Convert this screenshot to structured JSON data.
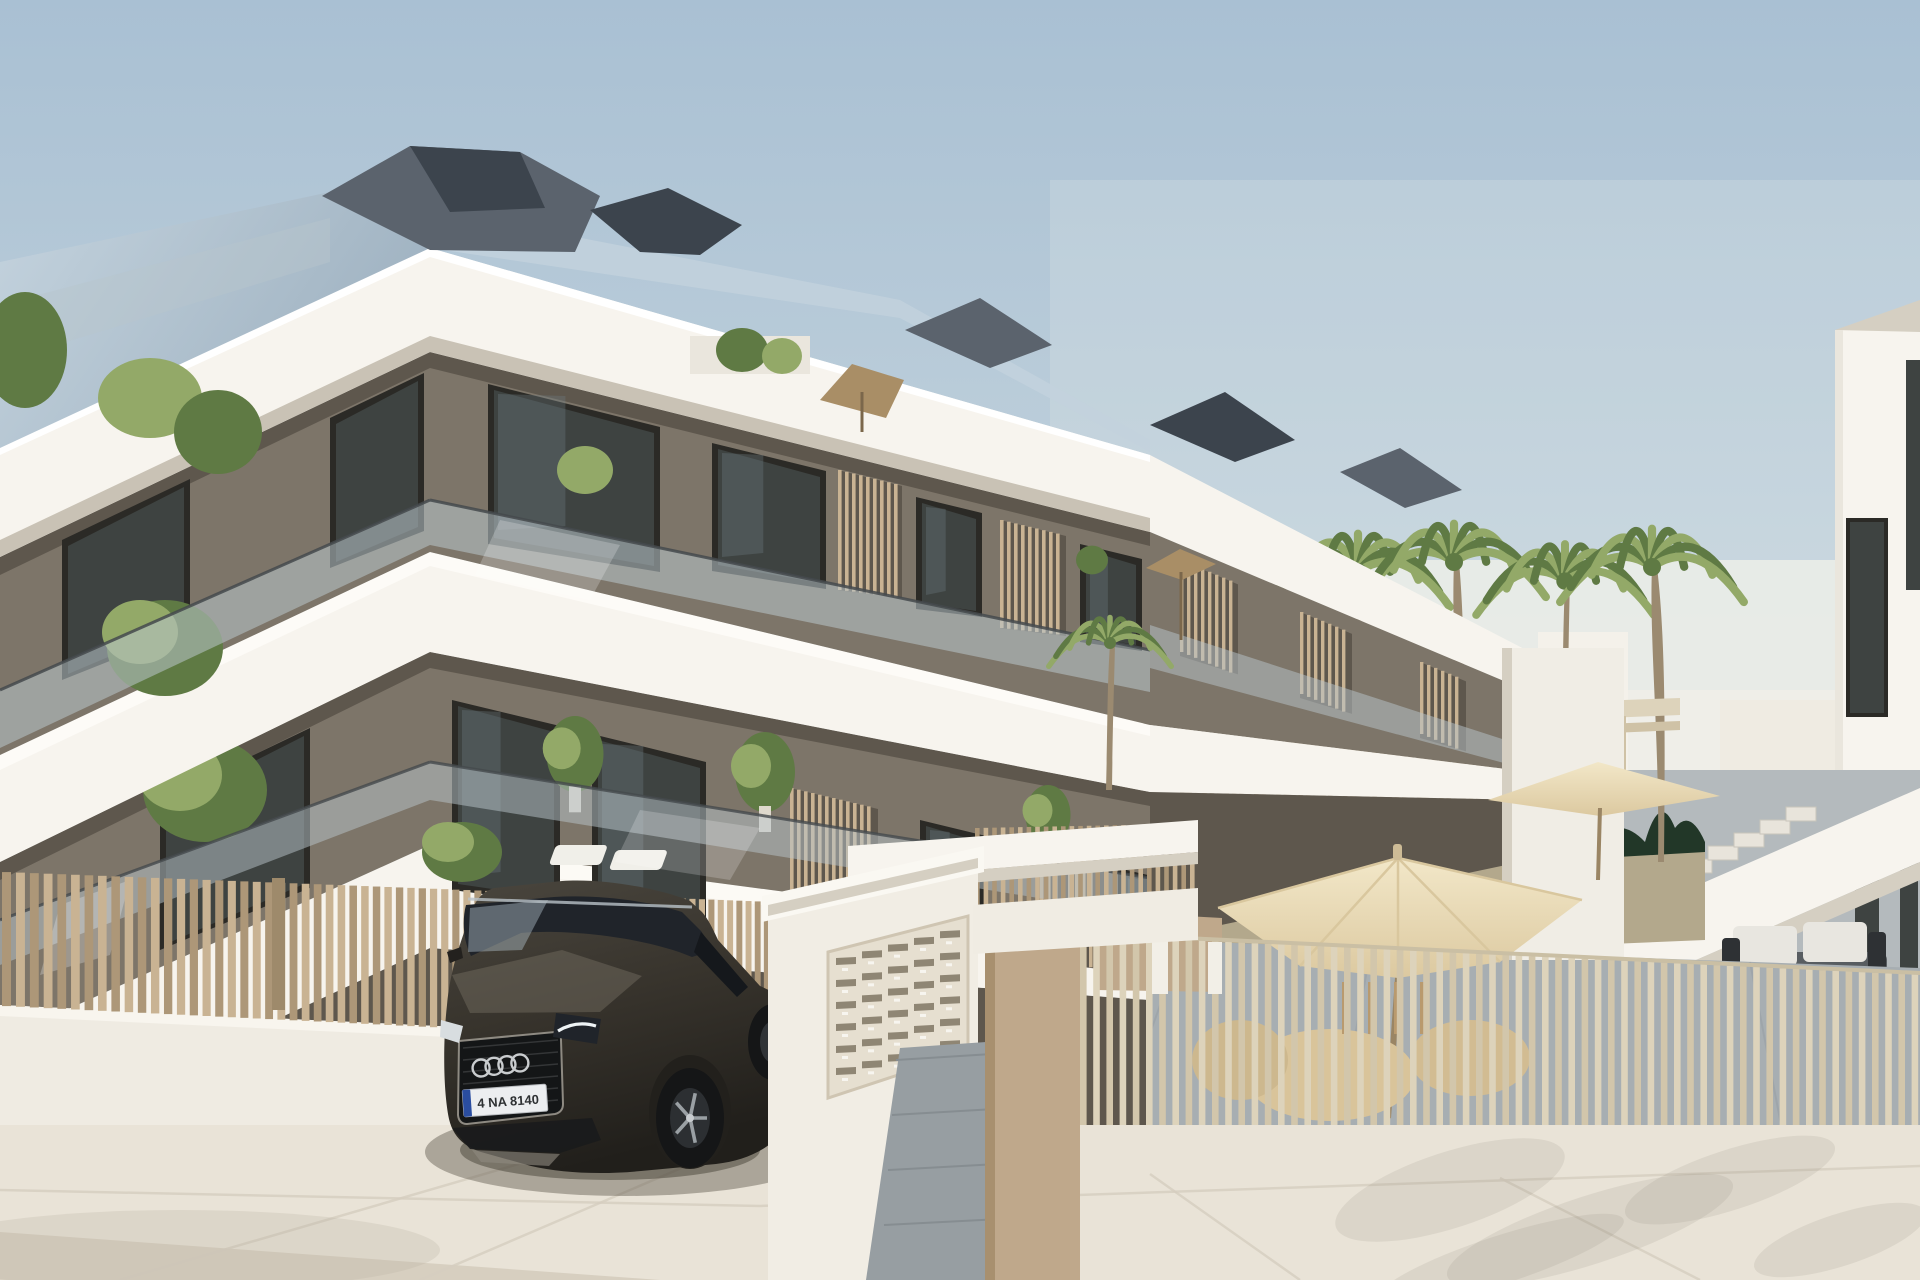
{
  "scene": {
    "type": "architectural_3d_render",
    "subject": "Modern three-storey white apartment building with glass balconies and wood-slat screens, palm courtyard with parasols behind a slatted fence, entrance gate with mailbox panel, and a dark SUV parked on the street",
    "sky": "clear pale blue, hazier toward the right horizon",
    "building": {
      "balcony_floors": 2,
      "slab_bands": 3,
      "has_roof_terrace": true
    },
    "courtyard": {
      "palm_count": 6,
      "umbrella_count": 4,
      "has_hedge": true,
      "has_pergola": true,
      "has_stairs": true
    },
    "car": {
      "logo": "four-rings",
      "license_plate": "4 NA 8140",
      "body_color": "#37332c"
    }
  },
  "palette": {
    "sky_top": "#a9c0d3",
    "sky_mid": "#c6d5de",
    "sky_horizon": "#e4e8e5",
    "white_lit": "#f7f4ee",
    "white_shade": "#eae6dd",
    "white_dark": "#d5cfc2",
    "soffit": "#c9c2b5",
    "taupe_lit": "#978e81",
    "taupe_mid": "#7d7569",
    "taupe_dark": "#5e574d",
    "glass_dark": "#3e4341",
    "frame_dark": "#2b2a26",
    "glass_reflect": "#6d7a80",
    "balustrade": "#b9c6cc",
    "balustrade_rail": "#454a4d",
    "roof_dark": "#3c444d",
    "roof_mid": "#5b636d",
    "roof_light": "#7d8893",
    "roof_slope": "#b7c8d5",
    "fence_tan": "#c9b393",
    "fence_tan_dark": "#ad9778",
    "fence_light": "#ddd3bb",
    "fence_gap": "#8d7d64",
    "wall_cream": "#efebe2",
    "pillar_tan": "#bfa88b",
    "hedge": "#223728",
    "garden": "#b3a88c",
    "palm_light": "#93a968",
    "palm_dark": "#5f7a44",
    "trunk": "#9b8a70",
    "umbrella_cream": "#ecdfbc",
    "umbrella_shade": "#d9c79e",
    "awning_tan": "#a98e66",
    "patio_gray": "#a7aeb2",
    "path_gray": "#979ea2",
    "ground": "#e9e3d7",
    "ground_shade": "#d7cfc0",
    "car_body": "#37332c",
    "car_dark": "#1d1c19",
    "car_glass": "#20242a",
    "car_sheen": "#8c867a",
    "plate_bg": "#eceef0",
    "plate_blue": "#2a4da0",
    "ring_silver": "#c9ccce"
  }
}
